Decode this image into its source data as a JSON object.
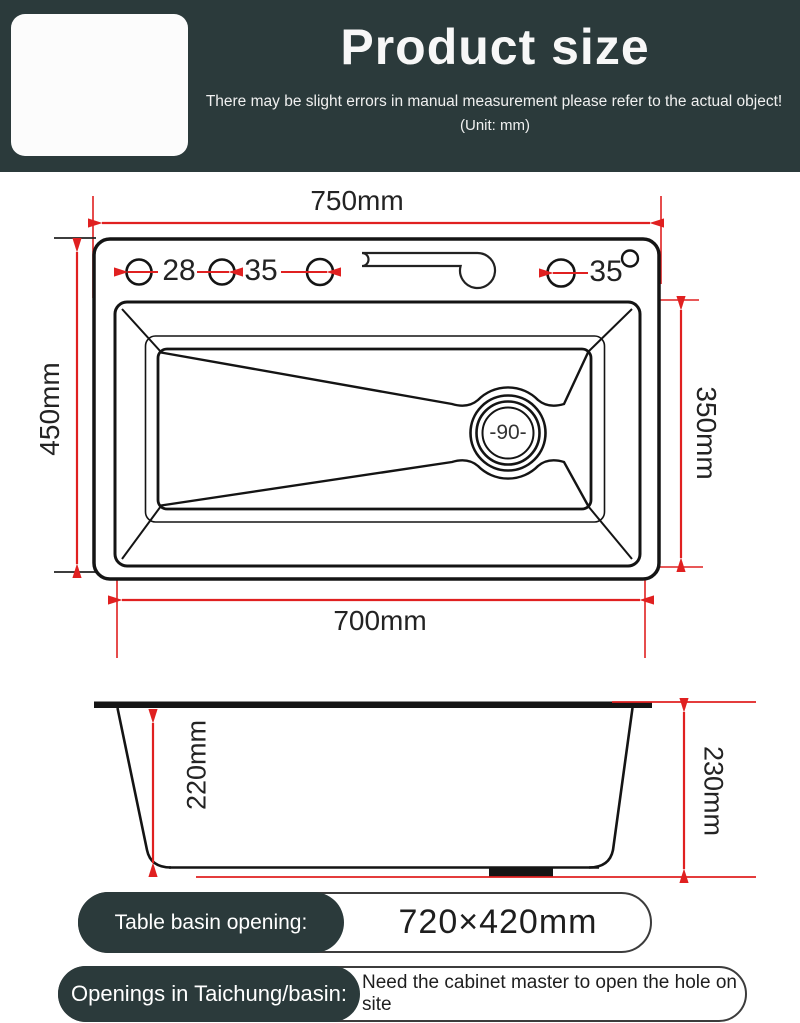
{
  "header": {
    "title": "Product size",
    "subtitle": "There may be slight errors in manual measurement  please refer to the actual object!",
    "unit_note": "(Unit: mm)"
  },
  "colors": {
    "banner": "#2b3a3b",
    "accent_red": "#e02020",
    "line_black": "#1a1a1a"
  },
  "top_view": {
    "overall_width": "750mm",
    "overall_depth": "450mm",
    "basin_depth": "350mm",
    "bottom_width": "700mm",
    "hole_labels": [
      "28",
      "35",
      "35"
    ],
    "drain_label": "-90-"
  },
  "side_view": {
    "inner_depth": "220mm",
    "outer_height": "230mm"
  },
  "footer": {
    "row1": {
      "label": "Table basin opening:",
      "value": "720×420mm"
    },
    "row2": {
      "label": "Openings in Taichung/basin:",
      "value": "Need the cabinet master to open the hole on site"
    }
  }
}
